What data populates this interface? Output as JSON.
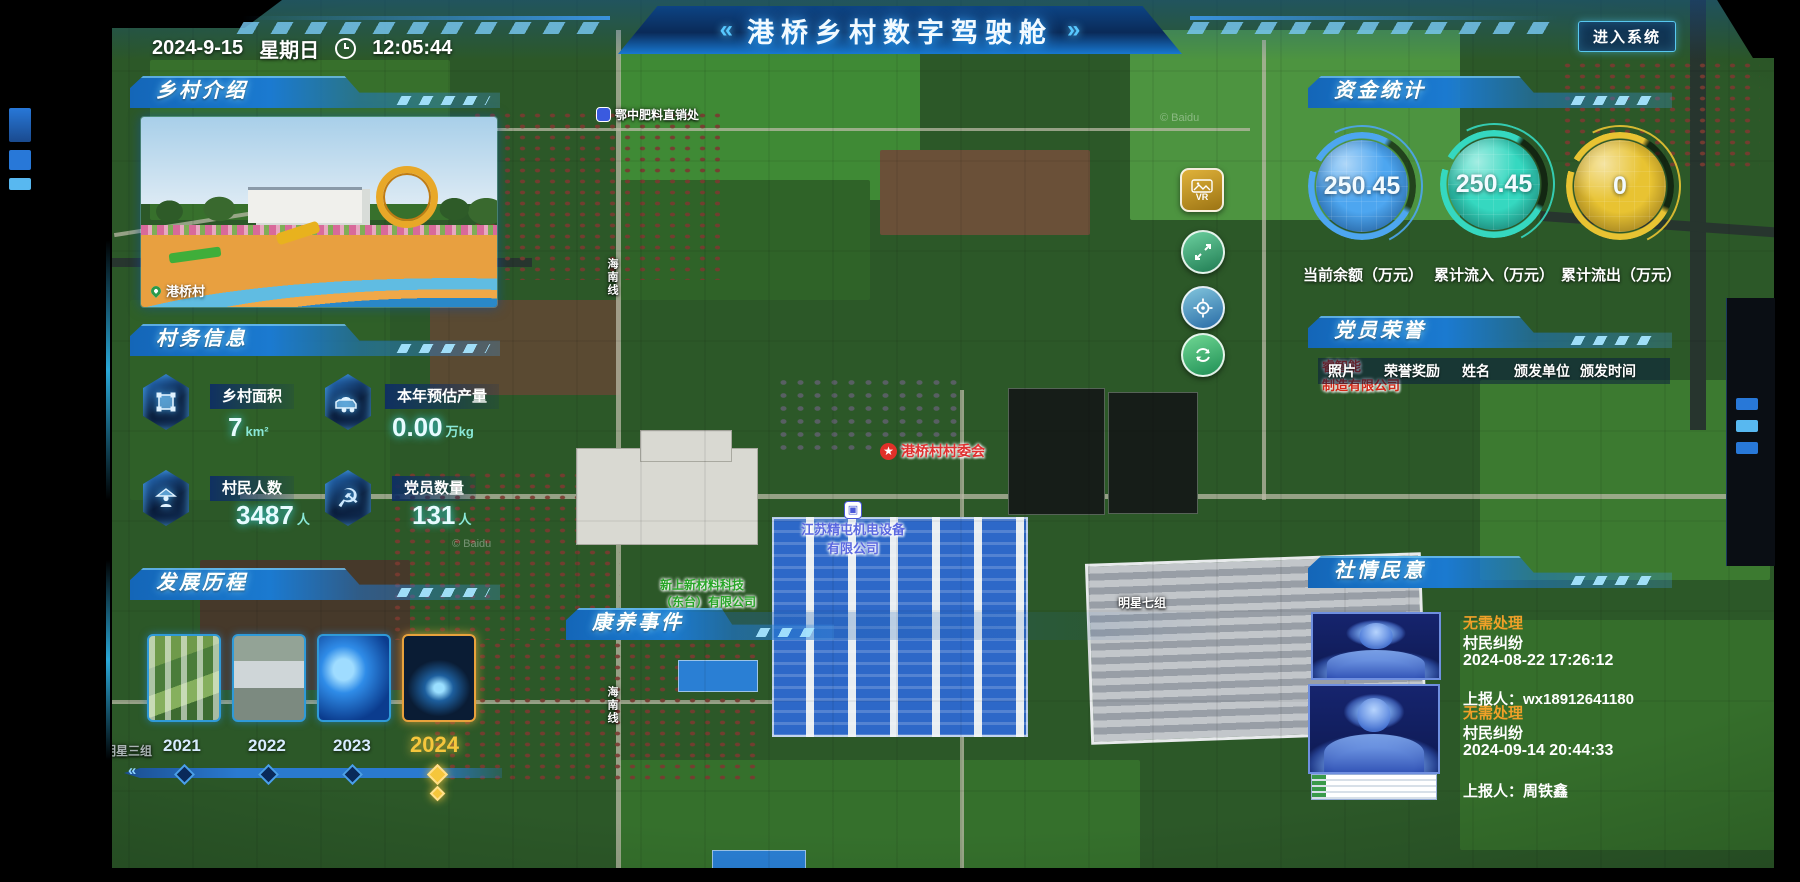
{
  "header": {
    "title": "港桥乡村数字驾驶舱",
    "left_deco": "«",
    "right_deco": "»",
    "date": "2024-9-15",
    "weekday": "星期日",
    "time": "12:05:44",
    "enter_button": "进入系统"
  },
  "panels": {
    "intro": {
      "title": "乡村介绍",
      "caption": "港桥村"
    },
    "info": {
      "title": "村务信息",
      "stats": [
        {
          "label": "乡村面积",
          "value": "7",
          "unit": "km²",
          "icon": "area-icon"
        },
        {
          "label": "本年预估产量",
          "value": "0.00",
          "unit": "万kg",
          "icon": "cart-icon"
        },
        {
          "label": "村民人数",
          "value": "3487",
          "unit": "人",
          "icon": "villager-icon"
        },
        {
          "label": "党员数量",
          "value": "131",
          "unit": "人",
          "icon": "party-icon"
        }
      ]
    },
    "history": {
      "title": "发展历程",
      "years": [
        {
          "label": "2021",
          "active": false
        },
        {
          "label": "2022",
          "active": false
        },
        {
          "label": "2023",
          "active": false
        },
        {
          "label": "2024",
          "active": true
        }
      ],
      "slider_chevron": "«"
    },
    "funds": {
      "title": "资金统计",
      "gauges": [
        {
          "value": "250.45",
          "label": "当前余额（万元）",
          "color": "#4da6f0"
        },
        {
          "value": "250.45",
          "label": "累计流入（万元）",
          "color": "#35d8c0"
        },
        {
          "value": "0",
          "label": "累计流出（万元）",
          "color": "#e8c332"
        }
      ]
    },
    "party": {
      "title": "党员荣誉",
      "columns": [
        "照片",
        "荣誉奖励",
        "姓名",
        "颁发单位",
        "颁发时间"
      ]
    },
    "sentiment": {
      "title": "社情民意",
      "entries": [
        {
          "status": "无需处理",
          "type": "村民纠纷",
          "time": "2024-08-22 17:26:12",
          "reporter": "上报人：wx18912641180"
        },
        {
          "status": "无需处理",
          "type": "村民纠纷",
          "time": "2024-09-14 20:44:33",
          "reporter": "上报人：周铁鑫"
        }
      ]
    },
    "health": {
      "title": "康养事件"
    }
  },
  "map": {
    "controls": {
      "vr": "VR"
    },
    "labels": {
      "fertilizer": "鄂中肥料直销处",
      "committee": "港桥村村委会",
      "company1_line1": "江苏精屯机电设备",
      "company1_line2": "有限公司",
      "company2_line1": "新上新材料科技",
      "company2_line2": "（东台）有限公司",
      "redco_line1": "睿智能",
      "redco_line2": "制造有限公司",
      "group7": "明星七组",
      "group3": "明星三组",
      "road": "海南线",
      "watermark": "© Baidu"
    }
  },
  "colors": {
    "accent": "#35c8ff",
    "header_blue": "#1b7ad0",
    "status_orange": "#f0a028",
    "year_active": "#f5c63c",
    "gauge_blue": "#4da6f0",
    "gauge_teal": "#35d8c0",
    "gauge_gold": "#e8c332"
  }
}
